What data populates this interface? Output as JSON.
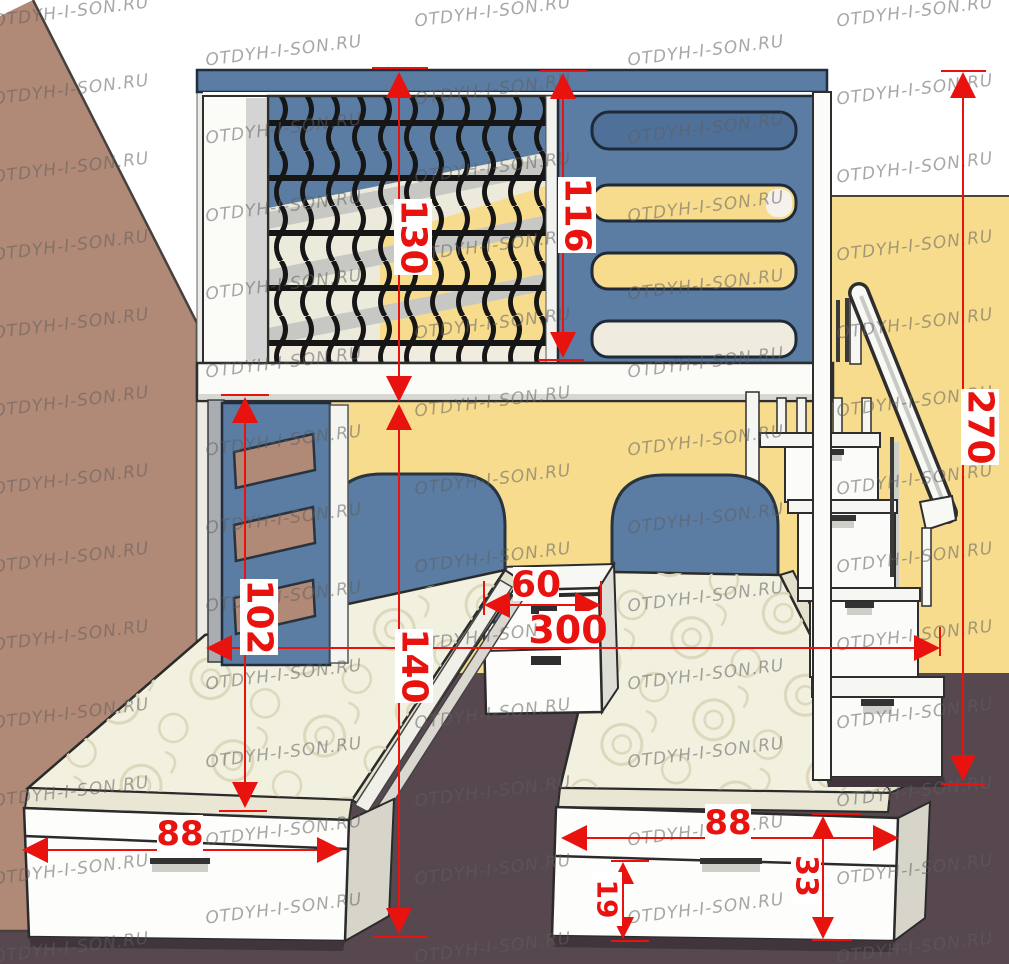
{
  "watermark": {
    "text": "OTDYH-I-SON.RU"
  },
  "palette": {
    "dimension_red": "#e8120e",
    "wall_brown": "#b18977",
    "wall_yellow": "#f8dc8e",
    "floor_plum": "#57484f",
    "furniture_blue": "#5b7ca3",
    "mattress_cream": "#f2f0de",
    "net_black": "#161616"
  },
  "dims": {
    "upper_bunk_height": "130",
    "guard_rail_height": "116",
    "total_height": "270",
    "ladder_height": "102",
    "clearance_height": "140",
    "nightstand_width": "60",
    "total_length": "300",
    "left_bed_width": "88",
    "right_bed_width": "88",
    "drawer_height": "19",
    "bed_base_height": "33"
  }
}
